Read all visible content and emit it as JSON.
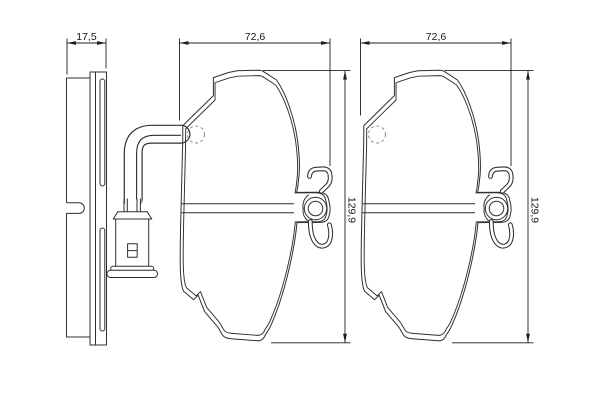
{
  "drawing": {
    "type": "brake-pad-set-technical-drawing",
    "colors": {
      "background": "#ffffff",
      "line": "#2f2f2f",
      "dimension_line": "#1f1f1f",
      "hidden_line": "#8f8f8f"
    },
    "dimensions": {
      "pad_thickness": "17,5",
      "left_pad_width": "72,6",
      "right_pad_width": "72,6",
      "left_pad_height": "129,9",
      "right_pad_height": "129,9"
    }
  }
}
